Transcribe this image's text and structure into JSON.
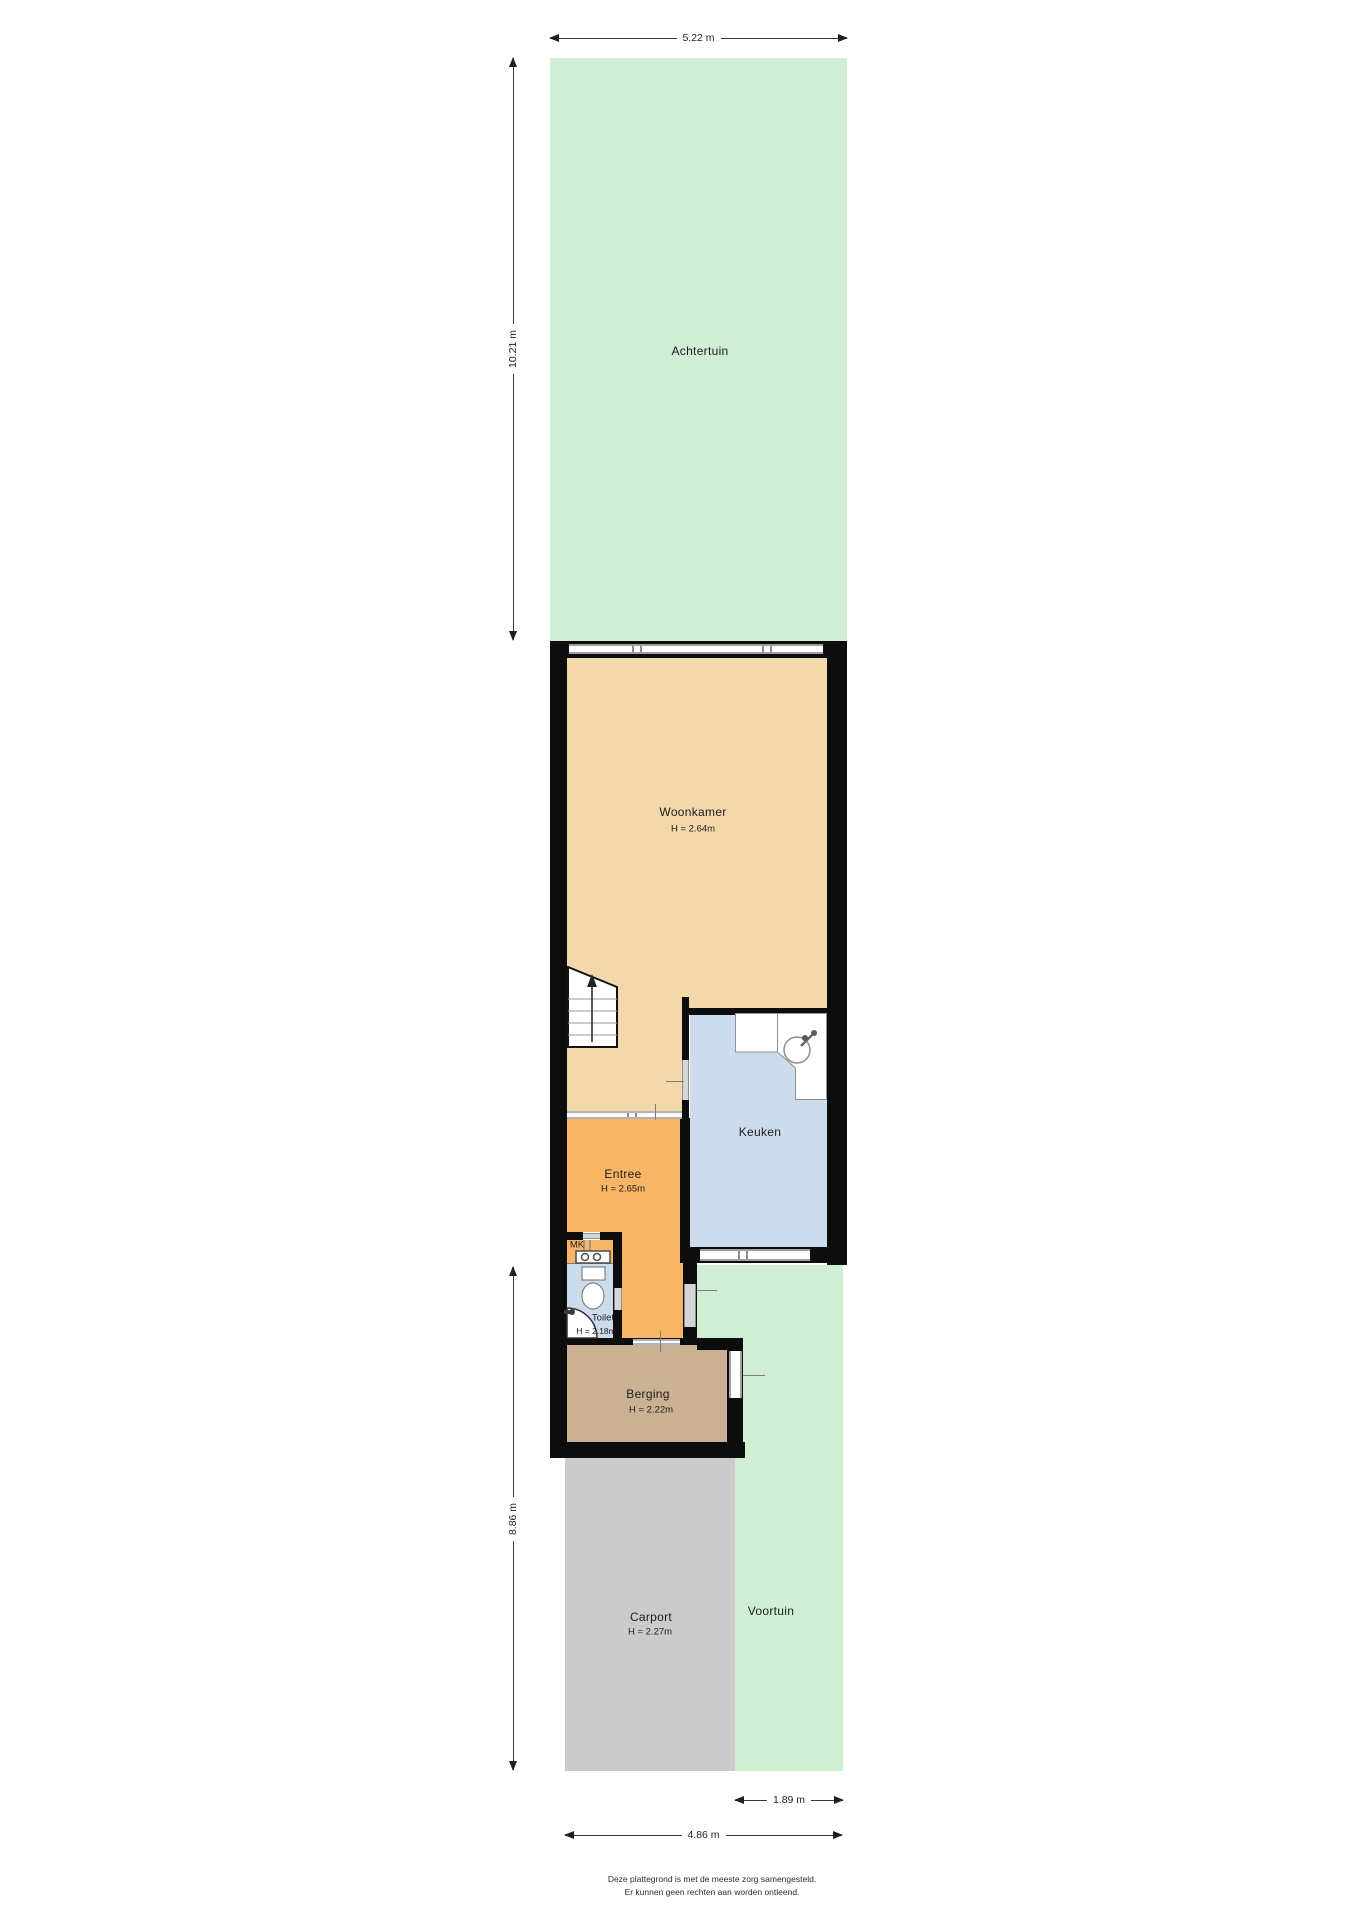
{
  "title": "Plattegrond begane grond met tuin",
  "rooms": {
    "achtertuin": {
      "label": "Achtertuin"
    },
    "woonkamer": {
      "label": "Woonkamer",
      "height": "H = 2.64m"
    },
    "keuken": {
      "label": "Keuken"
    },
    "entree": {
      "label": "Entree",
      "height": "H = 2.65m"
    },
    "mk": {
      "label": "MK"
    },
    "toilet": {
      "label": "Toilet",
      "height": "H = 2.18m"
    },
    "berging": {
      "label": "Berging",
      "height": "H = 2.22m"
    },
    "carport": {
      "label": "Carport",
      "height": "H = 2.27m"
    },
    "voortuin": {
      "label": "Voortuin"
    }
  },
  "dimensions": {
    "top_width": "5.22 m",
    "back_garden_depth": "10.21 m",
    "front_depth": "8.86 m",
    "front_garden_width": "1.89 m",
    "bottom_width": "4.86 m"
  },
  "footer": {
    "line1": "Deze plattegrond is met de meeste zorg samengesteld.",
    "line2": "Er kunnen geen rechten aan worden ontleend."
  },
  "colors": {
    "garden": "#cfeed3",
    "living_room": "#f2d8ab",
    "kitchen": "#ccdcec",
    "hall": "#f7b565",
    "toilet": "#ccdcec",
    "storage": "#cbb194",
    "carport": "#cbcbcb",
    "wall": "#0d0d0d"
  },
  "icons": {
    "stairs": "stairs-up-arrow",
    "sink": "kitchen-sink",
    "toilet": "toilet-bowl",
    "meter": "meter-box"
  }
}
